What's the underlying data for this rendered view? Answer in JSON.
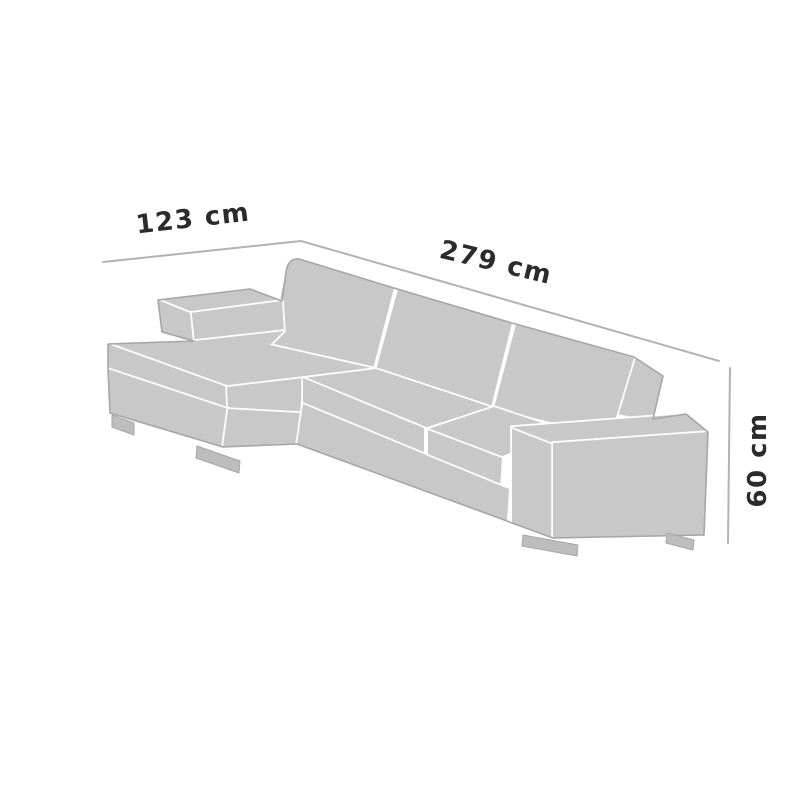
{
  "diagram": {
    "type": "furniture-dimension-diagram",
    "subject": "corner sectional sofa with left chaise",
    "dimensions": {
      "chaise_depth": {
        "label": "123 cm",
        "side": "top-left"
      },
      "width": {
        "label": "279 cm",
        "side": "top-right"
      },
      "height": {
        "label": "60 cm",
        "side": "right"
      }
    },
    "colors": {
      "background": "#ffffff",
      "sofa_fill": "#c8c8c8",
      "feet_fill": "#bdbdbd",
      "outline": "#a6a6a6",
      "panel_separator": "#ffffff",
      "dimension_line": "#b3b3b3",
      "label_text": "#2b2b2b"
    }
  }
}
